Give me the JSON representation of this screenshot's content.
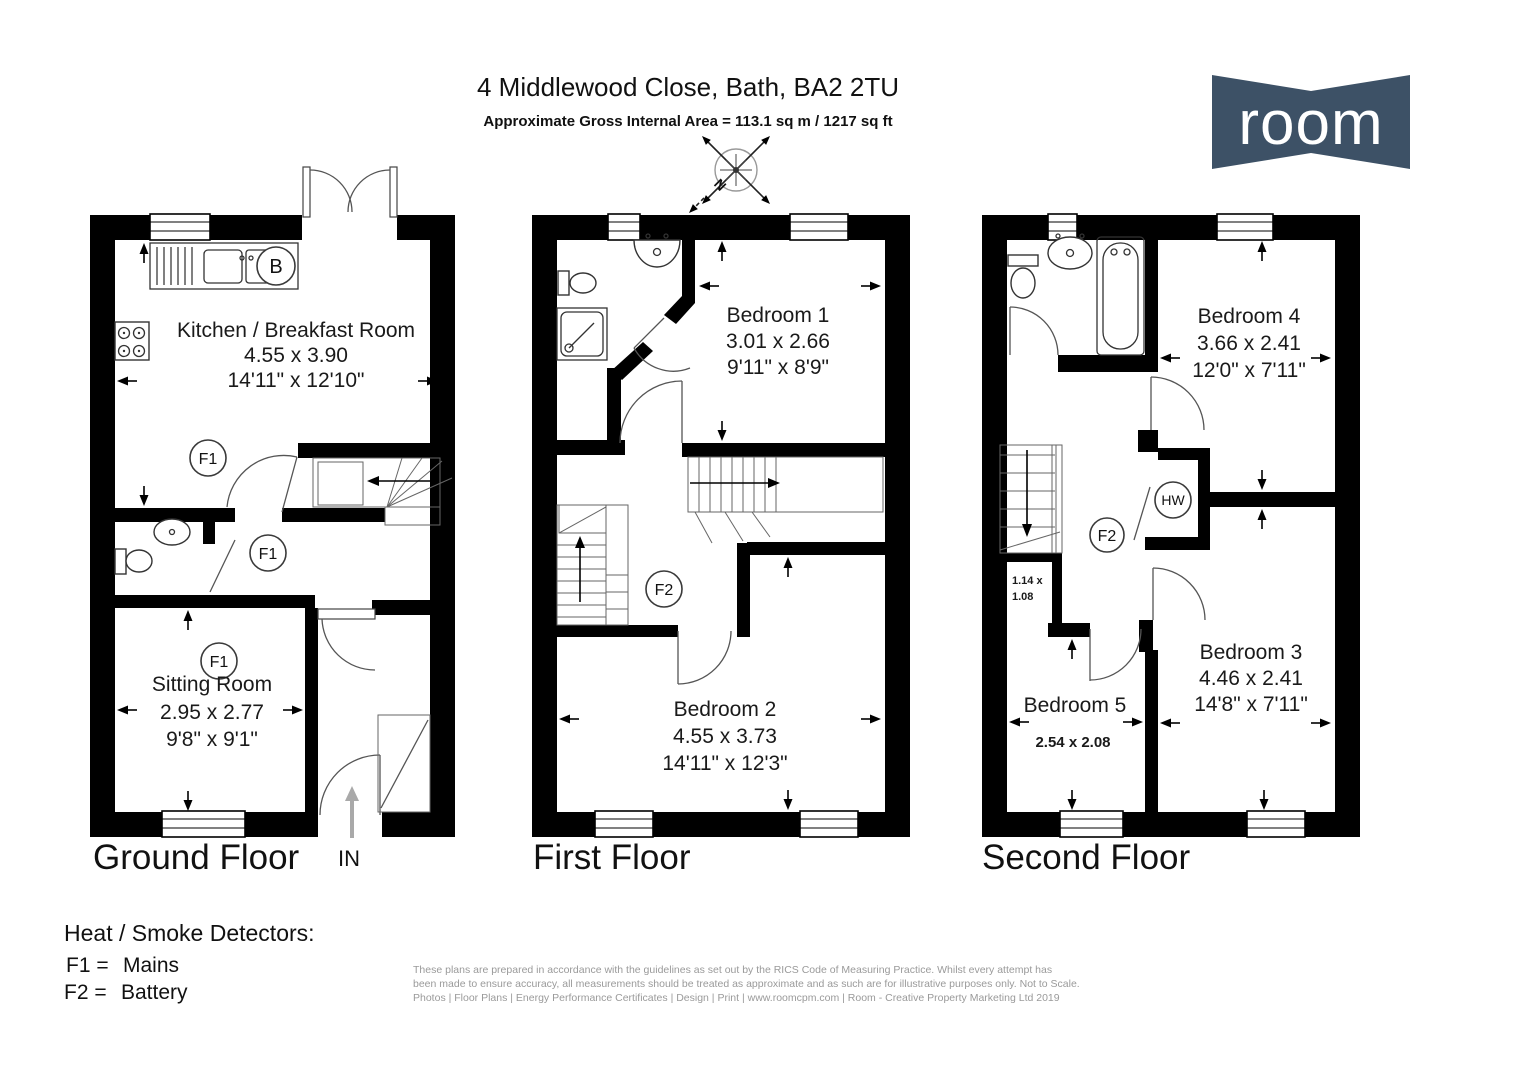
{
  "header": {
    "title": "4 Middlewood Close, Bath, BA2 2TU",
    "subtitle": "Approximate Gross Internal Area = 113.1 sq m / 1217 sq ft"
  },
  "logo": {
    "text": "room",
    "bg_color": "#3d5166",
    "text_color": "#ffffff"
  },
  "compass": {
    "north": "N"
  },
  "ground_floor": {
    "label": "Ground Floor",
    "entrance_label": "IN",
    "boiler_marker": "B",
    "kitchen_detector": "F1",
    "hall_detector": "F1",
    "sitting_detector": "F1",
    "kitchen": {
      "name": "Kitchen / Breakfast Room",
      "metric": "4.55 x 3.90",
      "imperial": "14'11\" x 12'10\""
    },
    "sitting_room": {
      "name": "Sitting Room",
      "metric": "2.95 x 2.77",
      "imperial": "9'8\" x 9'1\""
    }
  },
  "first_floor": {
    "label": "First Floor",
    "landing_detector": "F2",
    "bedroom1": {
      "name": "Bedroom 1",
      "metric": "3.01 x 2.66",
      "imperial": "9'11\" x 8'9\""
    },
    "bedroom2": {
      "name": "Bedroom 2",
      "metric": "4.55 x 3.73",
      "imperial": "14'11\" x 12'3\""
    }
  },
  "second_floor": {
    "label": "Second Floor",
    "landing_detector": "F2",
    "hot_water_marker": "HW",
    "store": {
      "line1": "1.14 x",
      "line2": "1.08"
    },
    "bedroom4": {
      "name": "Bedroom 4",
      "metric": "3.66 x 2.41",
      "imperial": "12'0\" x 7'11\""
    },
    "bedroom3": {
      "name": "Bedroom 3",
      "metric": "4.46 x 2.41",
      "imperial": "14'8\" x 7'11\""
    },
    "bedroom5": {
      "name": "Bedroom 5",
      "metric": "2.54 x 2.08"
    }
  },
  "legend": {
    "title": "Heat / Smoke Detectors:",
    "items": [
      {
        "code": "F1 =",
        "value": "Mains"
      },
      {
        "code": "F2 =",
        "value": "Battery"
      }
    ]
  },
  "disclaimer": {
    "line1": "These plans are prepared in accordance with the guidelines as set out by the RICS Code of Measuring Practice. Whilst every attempt has",
    "line2": "been made to ensure accuracy, all measurements should be treated as approximate and as such are for illustrative purposes only. Not to Scale.",
    "line3": "Photos | Floor Plans | Energy Performance Certificates | Design | Print | www.roomcpm.com | Room - Creative Property Marketing Ltd 2019"
  }
}
